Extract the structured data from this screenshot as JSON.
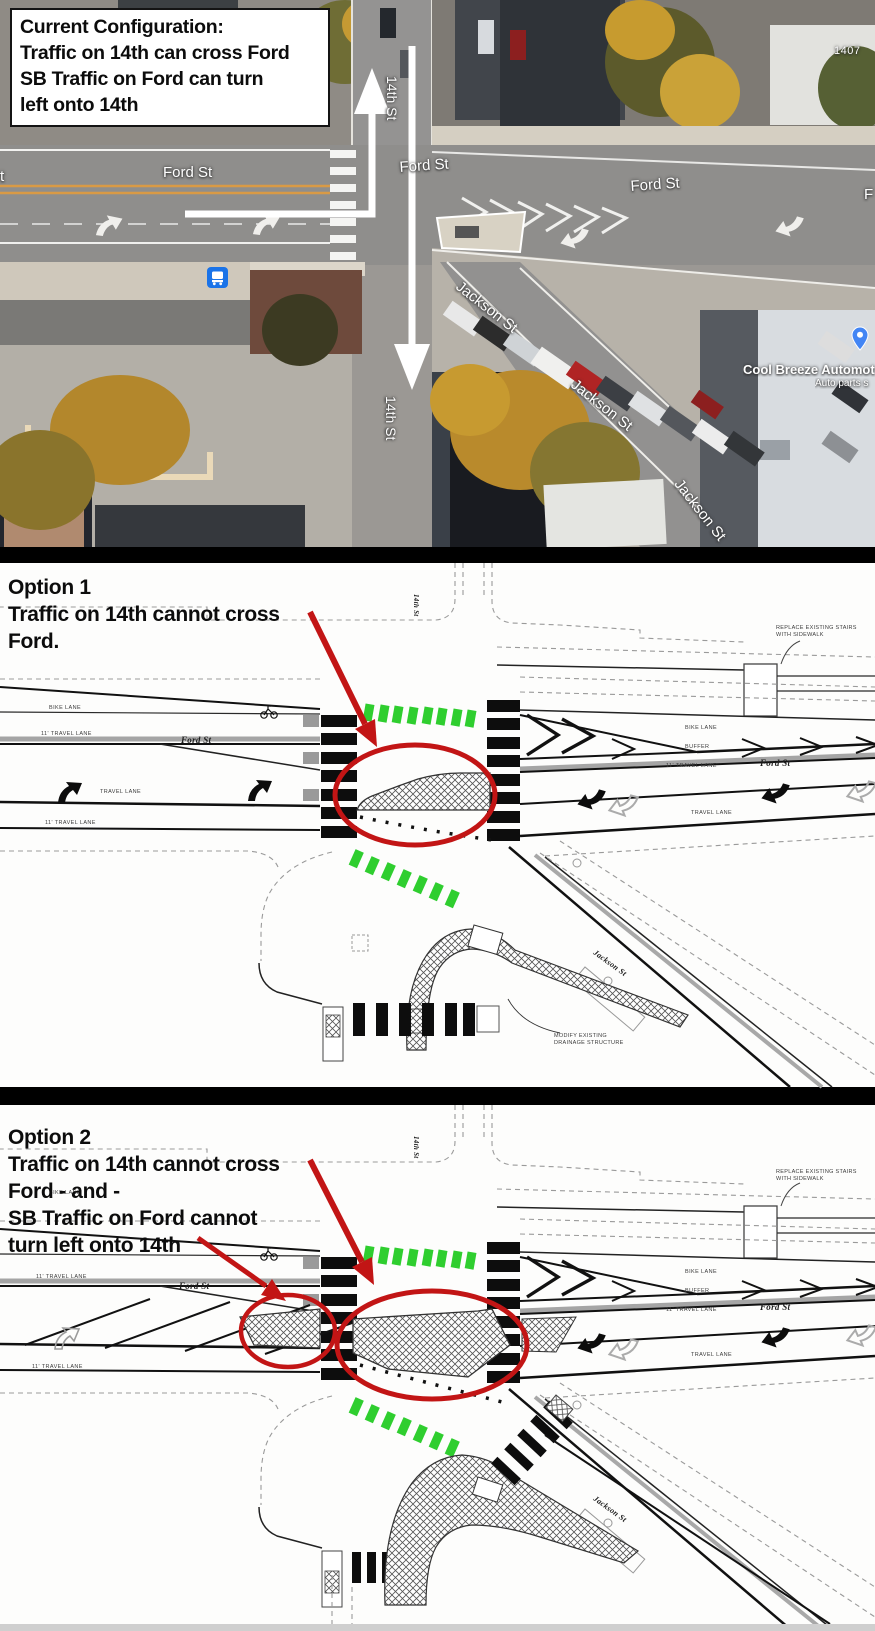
{
  "satellite": {
    "callout": {
      "line1": "Current Configuration:",
      "line2": "Traffic on 14th can cross Ford",
      "line3": "SB Traffic on Ford can turn",
      "line4": "left onto 14th"
    },
    "streets": {
      "ford": "Ford St",
      "jackson": "Jackson St",
      "fourteenth": "14th St",
      "ford_partial": "F",
      "street_partial": "t"
    },
    "poi": {
      "house_number": "1407",
      "business": "Cool Breeze Automot",
      "business_sub": "Auto parts s"
    },
    "icons": {
      "bus_stop": "bus-icon",
      "business_pin": "map-pin-icon"
    }
  },
  "option1": {
    "callout": {
      "line1": "Option 1",
      "line2": "Traffic on 14th cannot cross",
      "line3": "Ford."
    }
  },
  "option2": {
    "callout": {
      "line1": "Option 2",
      "line2": "Traffic on 14th cannot cross",
      "line3": "Ford - and -",
      "line4": "SB Traffic on Ford cannot",
      "line5": "turn left onto 14th"
    }
  },
  "plan": {
    "bike_lane": "BIKE LANE",
    "buffer": "BUFFER",
    "travel_lane": "TRAVEL LANE",
    "travel_lane_dim": "11' TRAVEL LANE",
    "ford": "Ford St",
    "jackson": "Jackson St",
    "fourteenth": "14th St",
    "replace_stairs_1": "REPLACE EXISTING STAIRS",
    "replace_stairs_2": "WITH SIDEWALK",
    "modify_drainage_1": "MODIFY EXISTING",
    "modify_drainage_2": "DRAINAGE STRUCTURE"
  },
  "colors": {
    "annotation_red": "#c21515",
    "bike_green": "#2fce2f",
    "divider": "#000000",
    "bus_blue": "#1a73e8",
    "pin_blue": "#4285f4"
  }
}
